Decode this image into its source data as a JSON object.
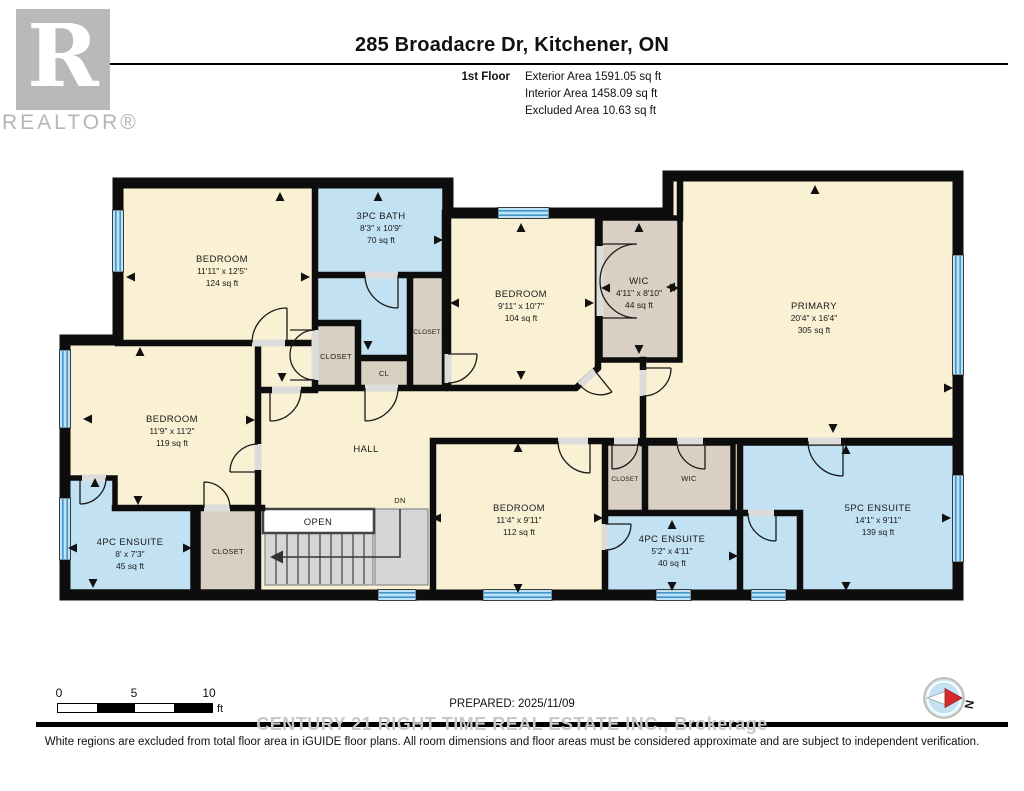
{
  "header": {
    "title": "285 Broadacre Dr, Kitchener, ON",
    "floor_label": "1st Floor",
    "exterior_area": "Exterior Area 1591.05 sq ft",
    "interior_area": "Interior Area 1458.09 sq ft",
    "excluded_area": "Excluded Area 10.63 sq ft",
    "realtor_r": "R",
    "realtor_logo_text": "REALTOR®"
  },
  "rooms": {
    "bedroom_top_left": {
      "name": "BEDROOM",
      "dims": "11'11\" x 12'5\"",
      "area": "124 sq ft"
    },
    "bath_3pc": {
      "name": "3PC BATH",
      "dims": "8'3\" x 10'9\"",
      "area": "70 sq ft"
    },
    "bedroom_center": {
      "name": "BEDROOM",
      "dims": "9'11\" x 10'7\"",
      "area": "104 sq ft"
    },
    "wic_upper": {
      "name": "WIC",
      "dims": "4'11\" x 8'10\"",
      "area": "44 sq ft"
    },
    "primary": {
      "name": "PRIMARY",
      "dims": "20'4\" x 16'4\"",
      "area": "305 sq ft"
    },
    "bedroom_left": {
      "name": "BEDROOM",
      "dims": "11'9\" x 11'2\"",
      "area": "119 sq ft"
    },
    "ensuite_4pc_left": {
      "name": "4PC ENSUITE",
      "dims": "8' x 7'3\"",
      "area": "45 sq ft"
    },
    "bedroom_bottom": {
      "name": "BEDROOM",
      "dims": "11'4\" x 9'11\"",
      "area": "112 sq ft"
    },
    "ensuite_4pc_right": {
      "name": "4PC ENSUITE",
      "dims": "5'2\" x 4'11\"",
      "area": "40 sq ft"
    },
    "ensuite_5pc": {
      "name": "5PC ENSUITE",
      "dims": "14'1\" x 9'11\"",
      "area": "139 sq ft"
    },
    "hall": {
      "name": "HALL"
    },
    "open": {
      "name": "OPEN"
    },
    "dn": {
      "name": "DN"
    },
    "cl": {
      "name": "CL"
    },
    "closet_upper": {
      "name": "CLOSET"
    },
    "closet_upper_right": {
      "name": "CLOSET"
    },
    "closet_left": {
      "name": "CLOSET"
    },
    "closet_bottom_right": {
      "name": "CLOSET"
    },
    "wic_lower": {
      "name": "WIC"
    }
  },
  "scale_bar": {
    "tick0": "0",
    "tick5": "5",
    "tick10": "10",
    "unit": "ft"
  },
  "footer": {
    "prepared": "PREPARED: 2025/11/09",
    "watermark": "CENTURY 21 RIGHT TIME REAL ESTATE INC., Brokerage",
    "disclaimer": "White regions are excluded from total floor area in iGUIDE floor plans. All room dimensions and floor areas must be considered approximate and are subject to independent verification.",
    "compass_label": "N"
  },
  "colors": {
    "wall": "#0d0d0d",
    "cream": "#FAF0D4",
    "blue": "#C2E2F4",
    "tan": "#D9D0C3",
    "window": "#BFE2F5",
    "winline": "#3E96CC",
    "stair": "#D6D6D6",
    "wm": "#c8c8c8",
    "red": "#D42A2A"
  }
}
